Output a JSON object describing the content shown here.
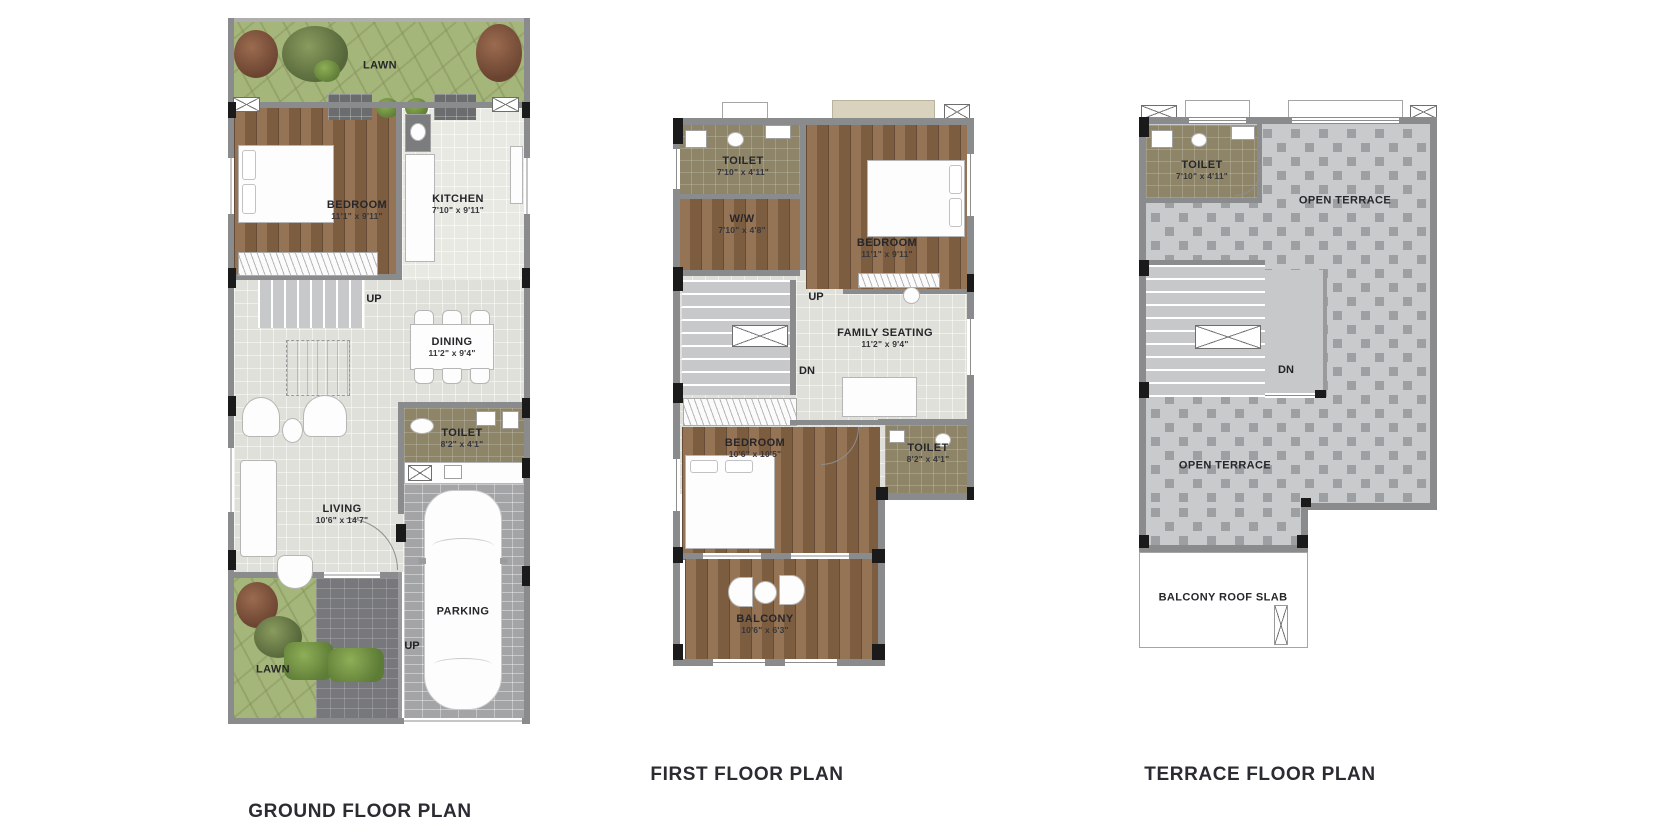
{
  "captions": {
    "ground": "GROUND FLOOR PLAN",
    "first": "FIRST FLOOR PLAN",
    "terrace": "TERRACE FLOOR PLAN"
  },
  "ground": {
    "lawn_top": "LAWN",
    "bedroom": {
      "name": "BEDROOM",
      "dims": "11'1\" x 9'11\""
    },
    "kitchen": {
      "name": "KITCHEN",
      "dims": "7'10\" x 9'11\""
    },
    "stair_up": "UP",
    "dining": {
      "name": "DINING",
      "dims": "11'2\" x 9'4\""
    },
    "toilet": {
      "name": "TOILET",
      "dims": "8'2\" x 4'1\""
    },
    "living": {
      "name": "LIVING",
      "dims": "10'6\" x 14'7\""
    },
    "parking": "PARKING",
    "drive_up": "UP",
    "lawn_bottom": "LAWN"
  },
  "first": {
    "toilet_top": {
      "name": "TOILET",
      "dims": "7'10\" x 4'11\""
    },
    "ww": {
      "name": "W/W",
      "dims": "7'10\" x 4'8\""
    },
    "bedroom_top": {
      "name": "BEDROOM",
      "dims": "11'1\" x 9'11\""
    },
    "stair_up": "UP",
    "stair_dn": "DN",
    "family": {
      "name": "FAMILY SEATING",
      "dims": "11'2\" x 9'4\""
    },
    "bedroom_bottom": {
      "name": "BEDROOM",
      "dims": "10'6\" x 10'5\""
    },
    "toilet_bottom": {
      "name": "TOILET",
      "dims": "8'2\" x 4'1\""
    },
    "balcony": {
      "name": "BALCONY",
      "dims": "10'6\" x 6'3\""
    }
  },
  "terrace": {
    "toilet": {
      "name": "TOILET",
      "dims": "7'10\" x 4'11\""
    },
    "open_terrace_right": "OPEN TERRACE",
    "stair_dn": "DN",
    "open_terrace_main": "OPEN TERRACE",
    "balcony_roof": "BALCONY ROOF SLAB"
  },
  "colors": {
    "wall": "#8a8b8d",
    "wood": "#8d6a49",
    "tile": "#dfe0d9",
    "olive": "#8e8569",
    "lawn": "#a5b67a",
    "checker_base": "#c9cacc",
    "checker_dot": "#9da0a3",
    "label_text": "#26262b"
  }
}
